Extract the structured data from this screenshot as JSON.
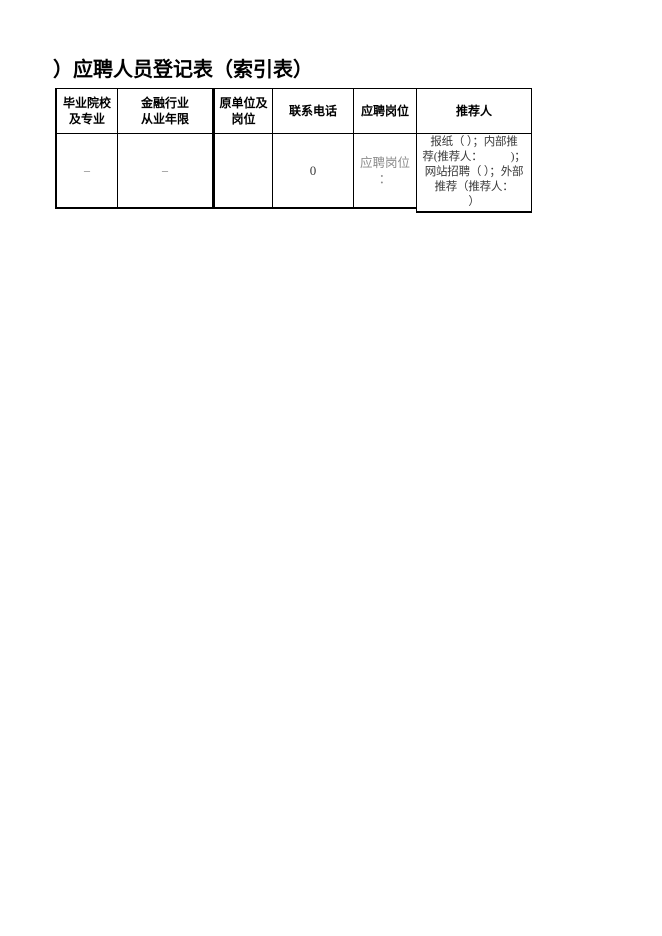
{
  "title": "）应聘人员登记表（索引表）",
  "table": {
    "headers": [
      "毕业院校\n及专业",
      "金融行业\n从业年限",
      "原单位及\n岗位",
      "联系电话",
      "应聘岗位",
      "推荐人"
    ],
    "row": [
      "–",
      "–",
      "",
      "0",
      "应聘岗位\n：",
      "报纸（ ）；内部推\n荐(推荐人：　　　)；\n网站招聘（ ）；外部\n推荐（推荐人：\n）"
    ]
  },
  "colors": {
    "text": "#000000",
    "border": "#000000",
    "background": "#ffffff",
    "cell_text": "#3a3a3a",
    "value_muted": "#6f6f6f",
    "placeholder": "#8c8c8c"
  }
}
